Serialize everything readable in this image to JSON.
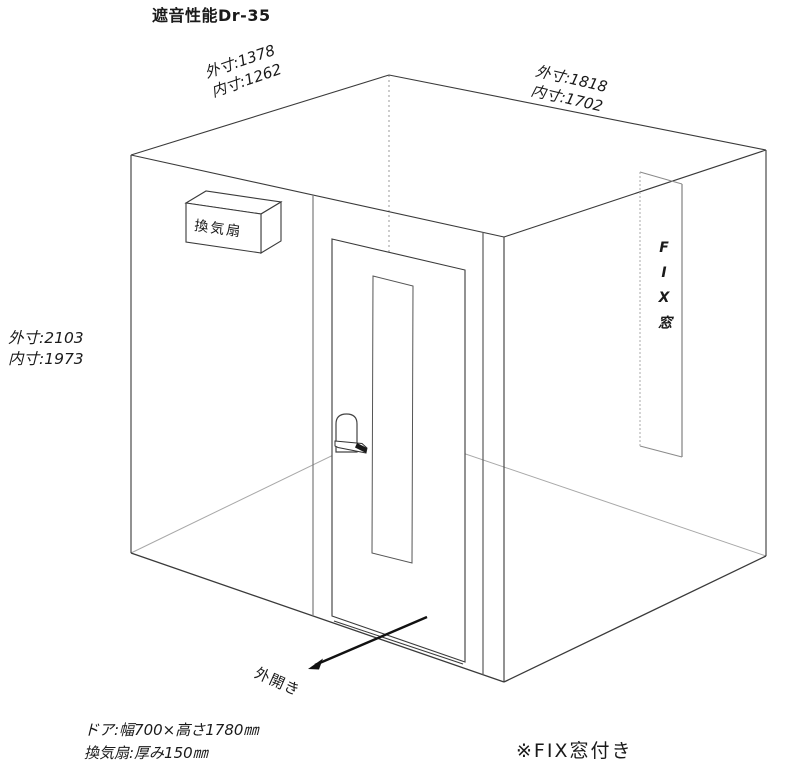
{
  "title": "遮音性能Dr-35",
  "dims": {
    "front_width": {
      "outer": "外寸:1378",
      "inner": "内寸:1262"
    },
    "side_depth": {
      "outer": "外寸:1818",
      "inner": "内寸:1702"
    },
    "height": {
      "outer": "外寸:2103",
      "inner": "内寸:1973"
    }
  },
  "labels": {
    "fan": "換気扇",
    "fix_window": "FIX窓",
    "door_swing": "外開き"
  },
  "notes": {
    "door": "ドア:幅700×高さ1780㎜",
    "fan": "換気扇:厚み150㎜",
    "fix": "※FIX窓付き"
  },
  "colors": {
    "ink": "#3a3a3a",
    "secondary_line": "#6a6a6a",
    "hidden_line": "#a8a8a8",
    "background": "#ffffff"
  }
}
